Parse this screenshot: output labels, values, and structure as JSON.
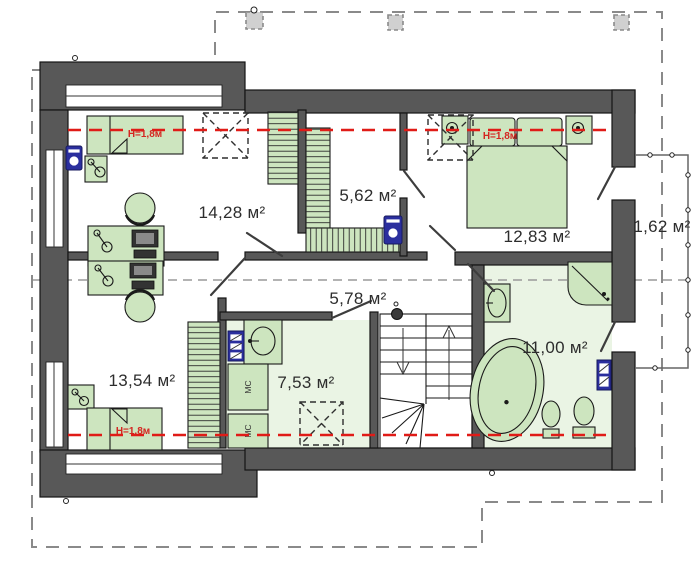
{
  "plan": {
    "type": "attic floor plan",
    "rooms": [
      {
        "name": "bedroom-top-left",
        "area": "14,28 м²"
      },
      {
        "name": "wardrobe-closet",
        "area": "5,62 м²"
      },
      {
        "name": "bedroom-top-right",
        "area": "12,83 м²"
      },
      {
        "name": "balcony",
        "area": "1,62 м²"
      },
      {
        "name": "hallway",
        "area": "5,78 м²"
      },
      {
        "name": "bedroom-bottom-left",
        "area": "13,54 м²"
      },
      {
        "name": "laundry-room",
        "area": "7,53 м²"
      },
      {
        "name": "bathroom",
        "area": "11,00 м²"
      }
    ],
    "height_marks": [
      "H=1,8м",
      "H=1,8м",
      "H=1,8м"
    ],
    "cabinet_labels": [
      "МС",
      "МС"
    ],
    "colors": {
      "wall": "#585858",
      "furniture_green": "#cde5bf",
      "floor_green": "#eaf4e4",
      "height_line_red": "#e01b17",
      "appliance_blue": "#2b2f9e",
      "roof_outline_gray": "#8a8a8a"
    }
  }
}
